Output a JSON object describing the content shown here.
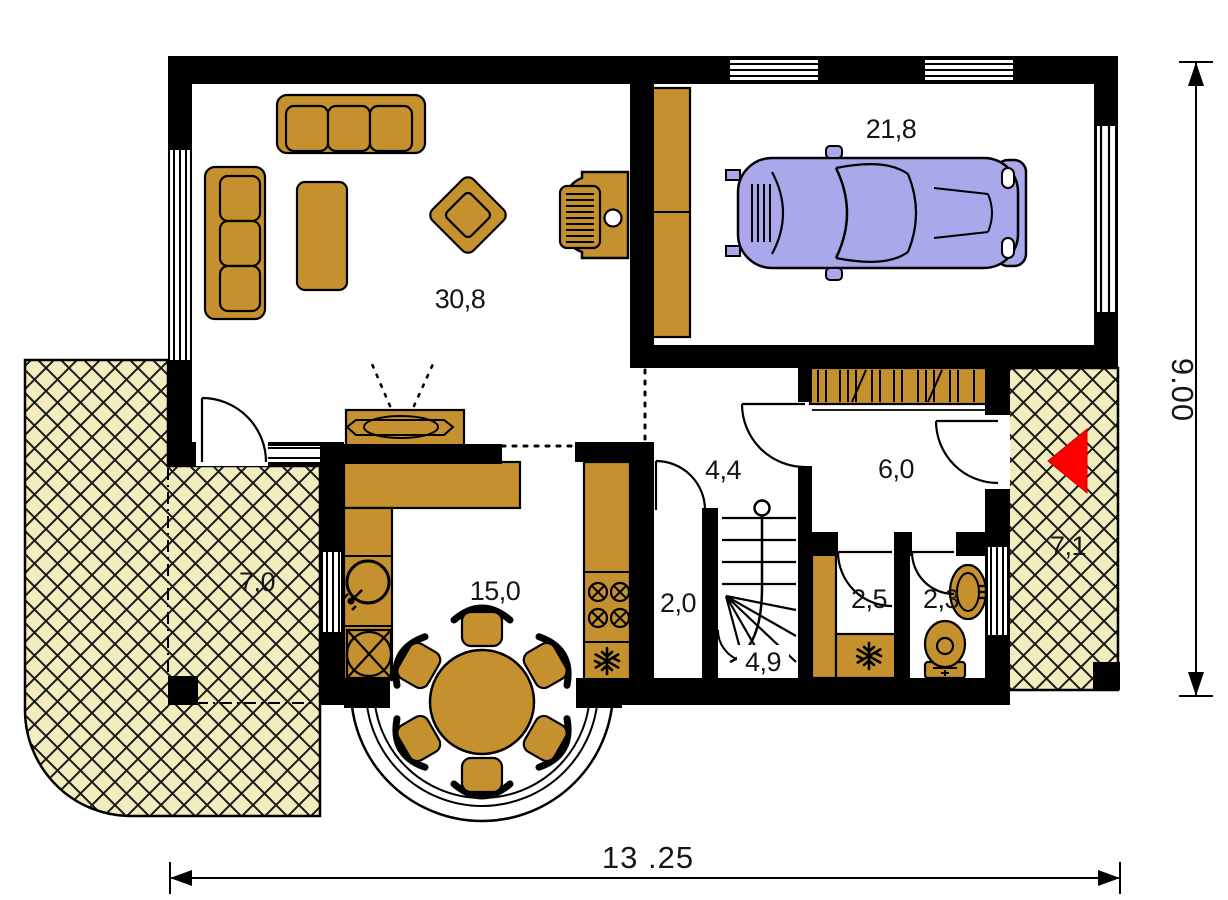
{
  "page": {
    "type": "house-ground-floor-plan"
  },
  "rooms": {
    "living_room": {
      "label": "30,8"
    },
    "garage": {
      "label": "21,8"
    },
    "kitchen": {
      "label": "15,0"
    },
    "hall": {
      "label": "4,4"
    },
    "vestibule": {
      "label": "6,0"
    },
    "pantry": {
      "label": "2,0"
    },
    "staircase": {
      "label": "4,9"
    },
    "storage": {
      "label": "2,5"
    },
    "wc": {
      "label": "2,3"
    },
    "terrace_left": {
      "label": "7,0"
    },
    "terrace_right": {
      "label": "7,1"
    }
  },
  "dimensions": {
    "overall_width": "13 .25",
    "overall_height": "9.00"
  },
  "fixtures": [
    "sofa",
    "armchair",
    "coffee-table",
    "tv-cabinet",
    "fireplace",
    "car",
    "garage-cabinet",
    "wardrobe",
    "kitchen-counter",
    "sink",
    "washer",
    "stove",
    "fridge",
    "freezer",
    "dining-table",
    "stairs",
    "toilet",
    "washbasin",
    "entry-arrow"
  ],
  "colors": {
    "wall": "#000000",
    "wood": "#C4912E",
    "terrace": "#F1EDBE",
    "car": "#A8A8EA",
    "entry": "#FF0000",
    "paper": "#FFFFFF"
  }
}
